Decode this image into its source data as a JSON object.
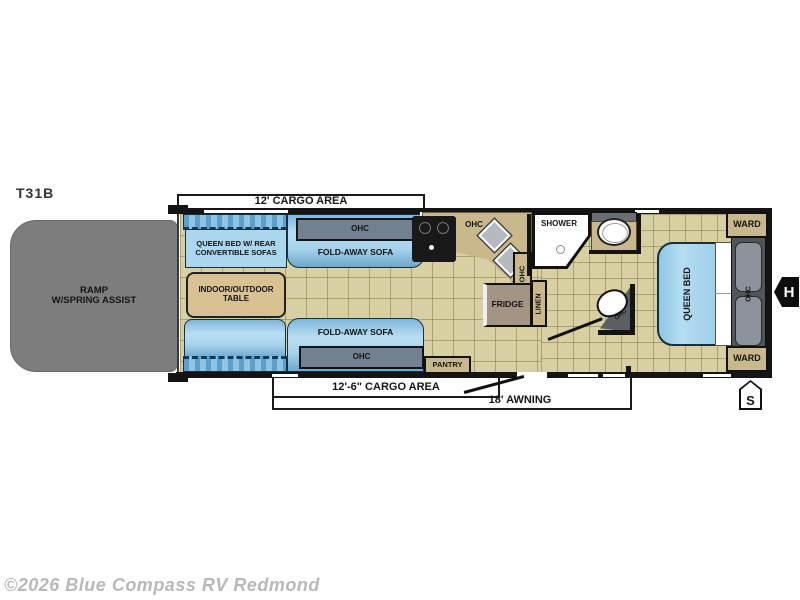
{
  "title": "T31B",
  "watermark": "©2026 Blue Compass RV Redmond",
  "dimensions": {
    "cargo_top": "12' CARGO AREA",
    "cargo_bottom": "12'-6\" CARGO AREA",
    "awning": "18' AWNING"
  },
  "rooms": {
    "ramp": "RAMP\nW/SPRING ASSIST",
    "queen_bed_sofas": "QUEEN BED W/ REAR\nCONVERTIBLE SOFAS",
    "table": "INDOOR/OUTDOOR\nTABLE",
    "fold_away_sofa": "FOLD-AWAY SOFA",
    "ohc": "OHC",
    "fridge": "FRIDGE",
    "linen": "LINEN",
    "pantry": "PANTRY",
    "shower": "SHOWER",
    "queen_bed": "QUEEN BED",
    "ward": "WARD"
  },
  "markers": {
    "hitch": "H",
    "step": "S"
  },
  "colors": {
    "sofa_blue": "#a9d5ec",
    "cabinet_gray": "#72808f",
    "wood_tan": "#c9b88b",
    "floor_tan": "#d8d0a2",
    "ramp_gray": "#7d7d7d",
    "wall_black": "#141414",
    "watermark_gray": "#b9b9b9"
  }
}
